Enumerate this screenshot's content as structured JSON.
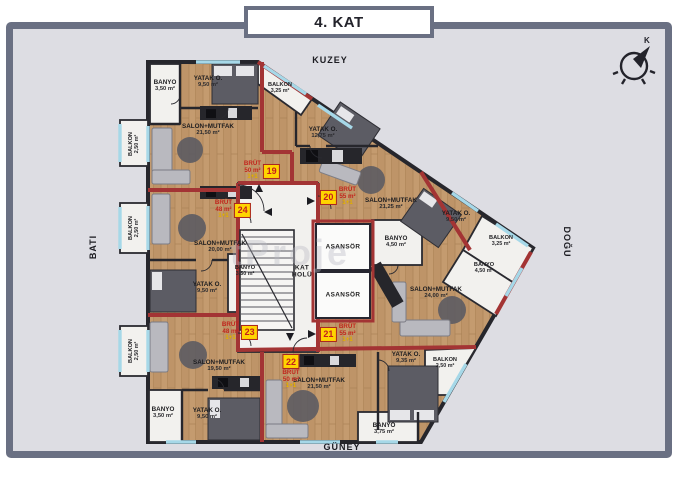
{
  "title": "4. KAT",
  "directions": {
    "north": "KUZEY",
    "south": "GÜNEY",
    "west": "BATI",
    "east": "DOĞU",
    "compass_letter": "K"
  },
  "watermark": "tProje",
  "hall": {
    "label_line1": "KAT",
    "label_line2": "HOLÜ",
    "elevator": "ASANSÖR"
  },
  "colors": {
    "frame": "#6a7083",
    "panel": "#dddde3",
    "wood": "#c49b6f",
    "unit_boundary_red": "#a33434",
    "wall": "#26262c",
    "window_glass": "#a6d8e8",
    "tag_yellow": "#ffd400",
    "tag_text_red": "#c41e1e"
  },
  "apartments": [
    {
      "no": "19",
      "gross_label": "BRÜT",
      "gross_area": "50 m²",
      "layout": "1+1",
      "rooms": [
        {
          "name": "BANYO",
          "area": "3,50 m²"
        },
        {
          "name": "YATAK O.",
          "area": "9,50 m²"
        },
        {
          "name": "SALON+MUTFAK",
          "area": "21,50 m²"
        },
        {
          "name": "BALKON",
          "area": "2,50 m²"
        }
      ]
    },
    {
      "no": "20",
      "gross_label": "BRÜT",
      "gross_area": "55 m²",
      "layout": "1+1",
      "rooms": [
        {
          "name": "YATAK O.",
          "area": "12,75 m²"
        },
        {
          "name": "SALON+MUTFAK",
          "area": "21,25 m²"
        },
        {
          "name": "BANYO",
          "area": "4,50 m²"
        },
        {
          "name": "BALKON",
          "area": "3,25 m²"
        }
      ]
    },
    {
      "no": "21",
      "gross_label": "BRÜT",
      "gross_area": "55 m²",
      "layout": "1+1",
      "rooms": [
        {
          "name": "YATAK O.",
          "area": "9,50 m²"
        },
        {
          "name": "BALKON",
          "area": "3,25 m²"
        },
        {
          "name": "BANYO",
          "area": "4,50 m²"
        },
        {
          "name": "SALON+MUTFAK",
          "area": "24,00 m²"
        }
      ]
    },
    {
      "no": "22",
      "gross_label": "BRÜT",
      "gross_area": "50 m²",
      "layout": "1+1",
      "rooms": [
        {
          "name": "YATAK O.",
          "area": "9,35 m²"
        },
        {
          "name": "BALKON",
          "area": "2,50 m²"
        },
        {
          "name": "SALON+MUTFAK",
          "area": "21,50 m²"
        },
        {
          "name": "BANYO",
          "area": "3,75 m²"
        }
      ]
    },
    {
      "no": "23",
      "gross_label": "BRÜT",
      "gross_area": "48 m²",
      "layout": "1+1",
      "rooms": [
        {
          "name": "SALON+MUTFAK",
          "area": "19,50 m²"
        },
        {
          "name": "BANYO",
          "area": "3,50 m²"
        },
        {
          "name": "YATAK O.",
          "area": "9,50 m²"
        },
        {
          "name": "BALKON",
          "area": "2,50 m²"
        }
      ]
    },
    {
      "no": "24",
      "gross_label": "BRÜT",
      "gross_area": "48 m²",
      "layout": "1+1",
      "rooms": [
        {
          "name": "SALON+MUTFAK",
          "area": "20,00 m²"
        },
        {
          "name": "YATAK O.",
          "area": "9,50 m²"
        },
        {
          "name": "BANYO",
          "area": "3,50 m²"
        },
        {
          "name": "BALKON",
          "area": "2,50 m²"
        }
      ]
    }
  ]
}
